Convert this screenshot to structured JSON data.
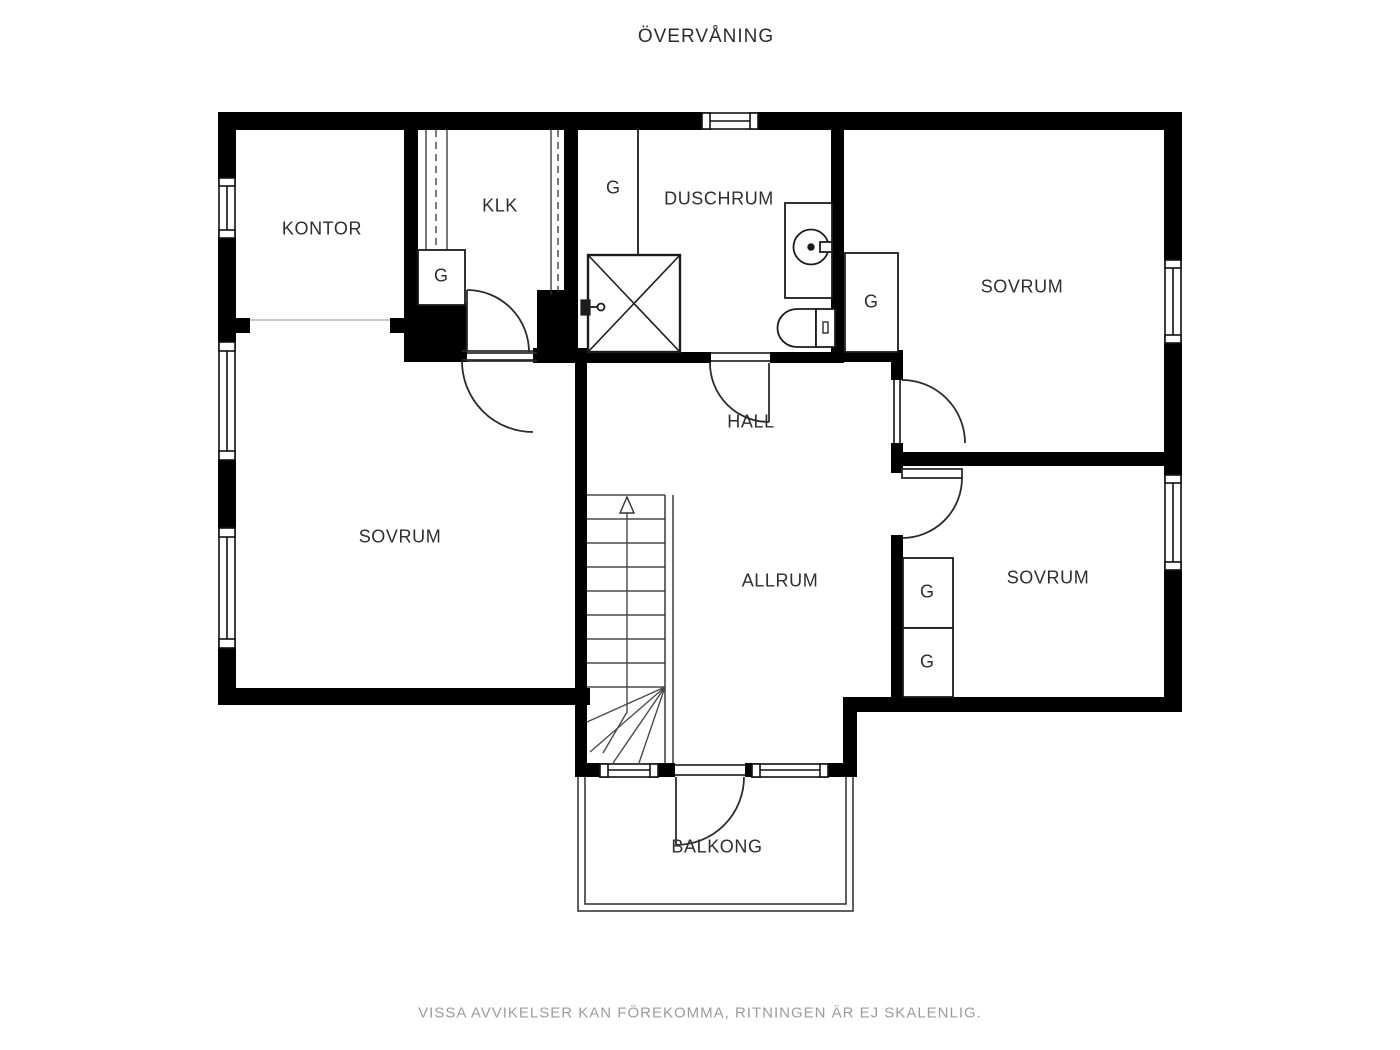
{
  "title": "ÖVERVÅNING",
  "floor_plan": {
    "rooms": [
      {
        "id": "kontor",
        "label": "KONTOR"
      },
      {
        "id": "klk",
        "label": "KLK"
      },
      {
        "id": "duschrum",
        "label": "DUSCHRUM"
      },
      {
        "id": "sovrum-top-right",
        "label": "SOVRUM"
      },
      {
        "id": "hall",
        "label": "HALL"
      },
      {
        "id": "sovrum-left",
        "label": "SOVRUM"
      },
      {
        "id": "allrum",
        "label": "ALLRUM"
      },
      {
        "id": "sovrum-bottom-right",
        "label": "SOVRUM"
      },
      {
        "id": "balkong",
        "label": "BALKONG"
      }
    ],
    "wardrobes": [
      {
        "id": "g-klk",
        "label": "G"
      },
      {
        "id": "g-duschrum-left",
        "label": "G"
      },
      {
        "id": "g-sovrum-top-right",
        "label": "G"
      },
      {
        "id": "g-sovrum-bottom-1",
        "label": "G"
      },
      {
        "id": "g-sovrum-bottom-2",
        "label": "G"
      }
    ],
    "fixture_icons": [
      "shower-icon",
      "sink-icon",
      "toilet-icon",
      "stairs",
      "balcony-railing",
      "stair-direction-arrow"
    ]
  },
  "footer": {
    "disclaimer": "VISSA AVVIKELSER KAN FÖREKOMMA, RITNINGEN ÄR EJ SKALENLIG."
  },
  "colors": {
    "wall": "#000000",
    "line": "#1c1c1c",
    "door_arc": "#2b2b2b",
    "label": "#2e2e2e",
    "footer_text": "#9c9c9c",
    "opening_line": "#c9c9c9",
    "background": "#ffffff"
  }
}
